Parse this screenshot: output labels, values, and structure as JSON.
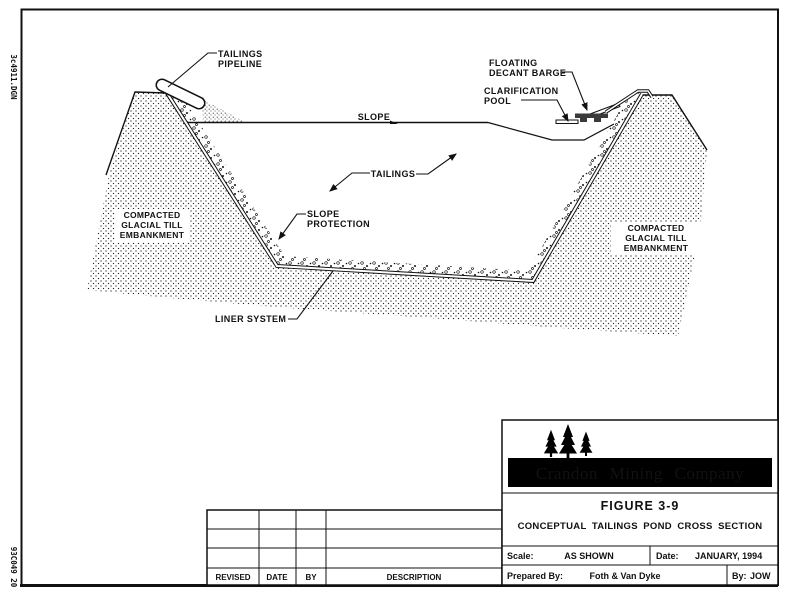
{
  "document": {
    "type": "engineering-drawing",
    "sheet_bg": "#ffffff",
    "ink": "#111111"
  },
  "margin_notes": {
    "top_left": "3c4911.DGN",
    "bottom_left": "93C049 20"
  },
  "diagram": {
    "callouts": {
      "tailings_pipeline": {
        "lines": [
          "TAILINGS",
          "PIPELINE"
        ]
      },
      "floating_decant_barge": {
        "lines": [
          "FLOATING",
          "DECANT BARGE"
        ]
      },
      "clarification_pool": {
        "lines": [
          "CLARIFICATION",
          "POOL"
        ]
      },
      "slope": {
        "lines": [
          "SLOPE"
        ]
      },
      "tailings": {
        "lines": [
          "TAILINGS"
        ]
      },
      "slope_protection": {
        "lines": [
          "SLOPE",
          "PROTECTION"
        ]
      },
      "embankment_left": {
        "lines": [
          "COMPACTED",
          "GLACIAL TILL",
          "EMBANKMENT"
        ]
      },
      "embankment_right": {
        "lines": [
          "COMPACTED",
          "GLACIAL TILL",
          "EMBANKMENT"
        ]
      },
      "liner_system": {
        "lines": [
          "LINER SYSTEM"
        ]
      }
    }
  },
  "title_block": {
    "logo": "pine-trees-icon",
    "company": "Crandon Mining Company",
    "figure": "FIGURE 3-9",
    "title": "CONCEPTUAL TAILINGS POND CROSS SECTION",
    "scale_label": "Scale:",
    "scale_value": "AS SHOWN",
    "date_label": "Date:",
    "date_value": "JANUARY, 1994",
    "prepared_label": "Prepared By:",
    "prepared_value": "Foth & Van Dyke",
    "by_label": "By:",
    "by_value": "JOW"
  },
  "revision_table": {
    "headers": [
      "REVISED",
      "DATE",
      "BY",
      "DESCRIPTION"
    ],
    "rows": [
      [
        "",
        "",
        "",
        ""
      ],
      [
        "",
        "",
        "",
        ""
      ],
      [
        "",
        "",
        "",
        ""
      ]
    ]
  },
  "colors": {
    "paper": "#ffffff",
    "ink": "#111111",
    "company_bar": "#000000",
    "barge": "#3a3a3a"
  }
}
